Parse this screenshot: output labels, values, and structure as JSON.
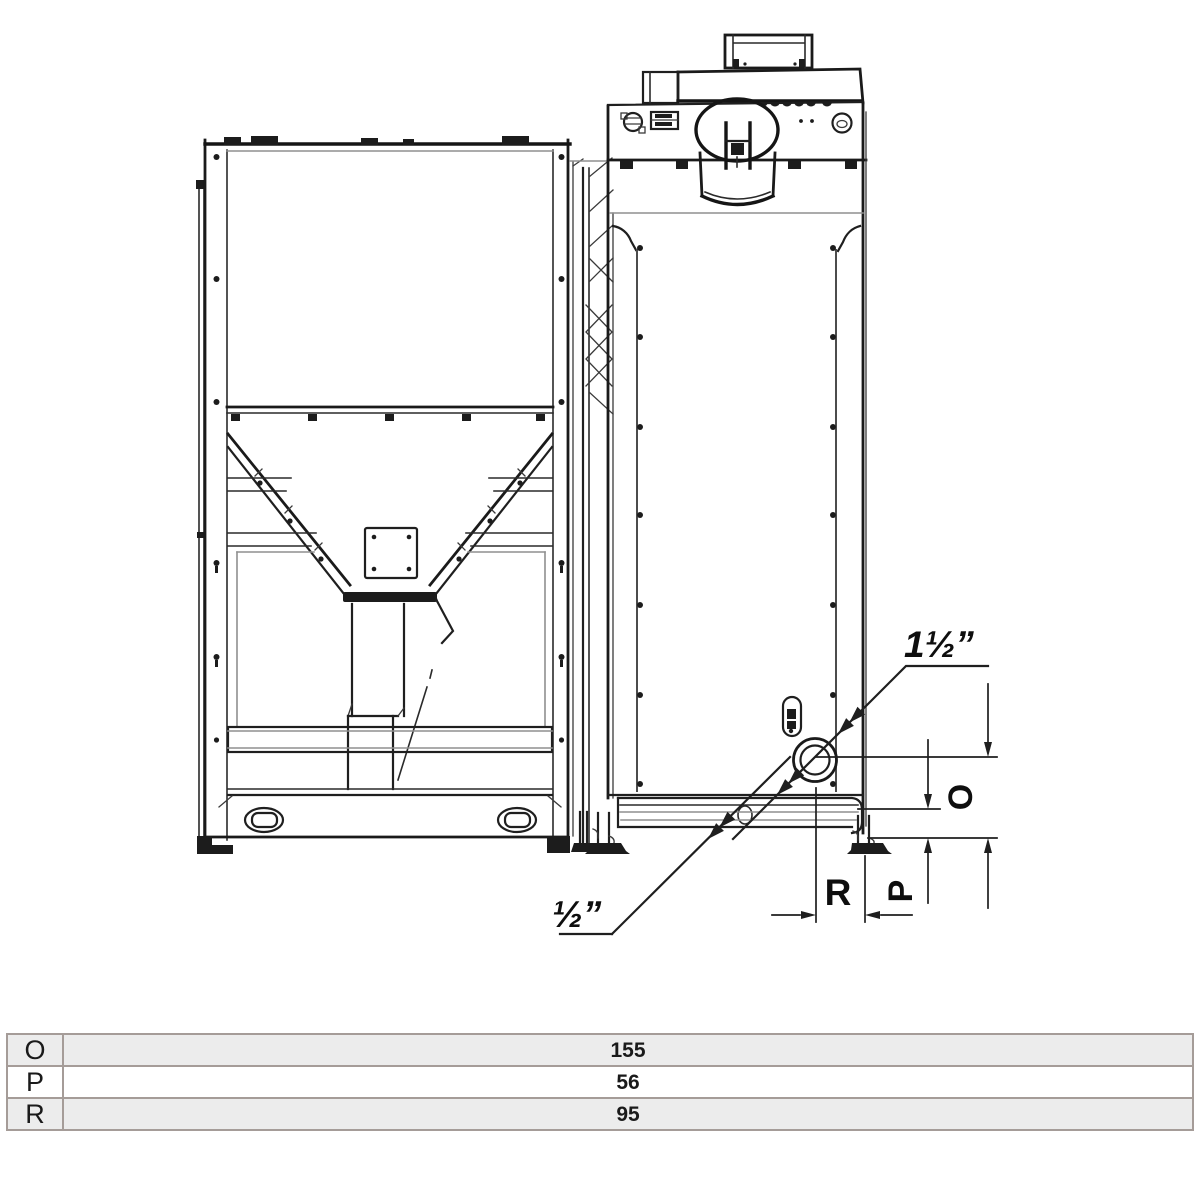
{
  "drawing": {
    "type": "technical-diagram",
    "subject": "pellet boiler with fuel hopper, rear view, pipe connection dimensions",
    "labels": {
      "fitting_large": "1½”",
      "fitting_small": "½”",
      "dim_o": "O",
      "dim_p": "P",
      "dim_r": "R"
    },
    "colors": {
      "line": "#1f1f1f",
      "light_line": "#8f8f8f",
      "background": "#ffffff"
    }
  },
  "dimensions_table": {
    "rows": [
      {
        "label": "O",
        "value": "155"
      },
      {
        "label": "P",
        "value": "56"
      },
      {
        "label": "R",
        "value": "95"
      }
    ],
    "border_color": "#a59c98",
    "row_bg_odd": "#ececec",
    "row_bg_even": "#ffffff"
  }
}
